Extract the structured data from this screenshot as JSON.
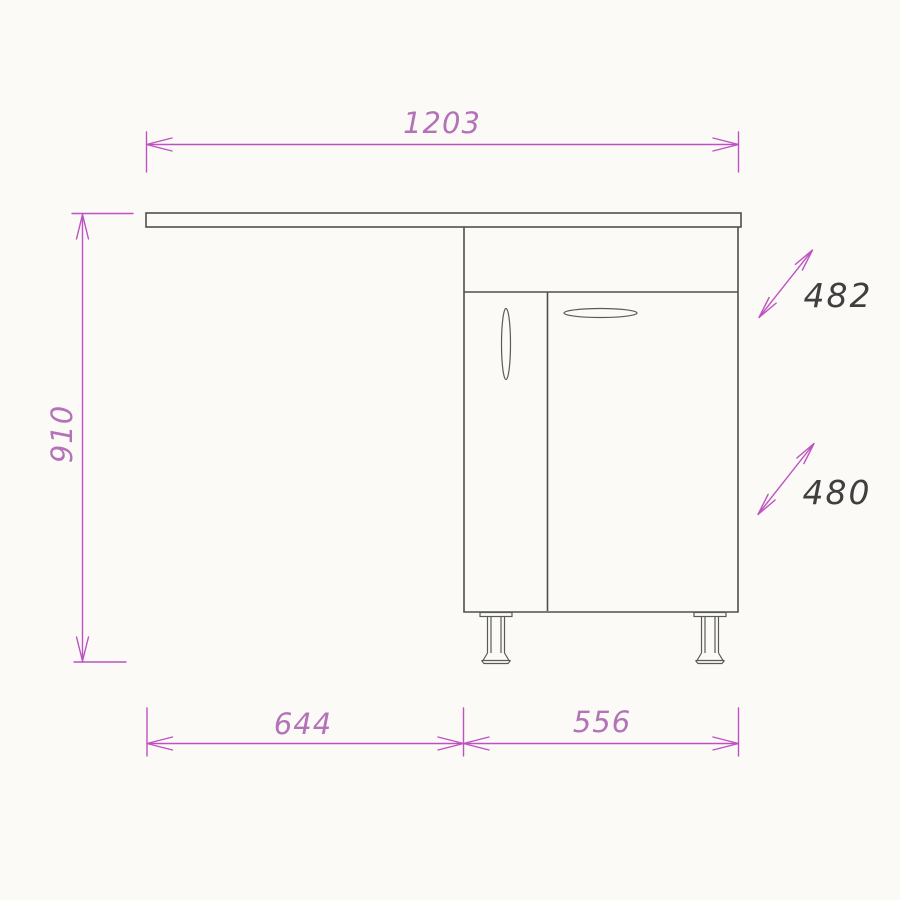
{
  "drawing": {
    "dimension_labels": {
      "top_width": "1203",
      "left_height": "910",
      "right_upper": "482",
      "right_lower": "480",
      "bottom_left": "644",
      "bottom_right": "556"
    },
    "colors": {
      "dimension_line": "#bd53c0",
      "dimension_text_magenta": "#b472b8",
      "dimension_text_dark": "#3f3f3f",
      "object_line": "#4f4f4f",
      "background": "#fbfaf7"
    }
  }
}
